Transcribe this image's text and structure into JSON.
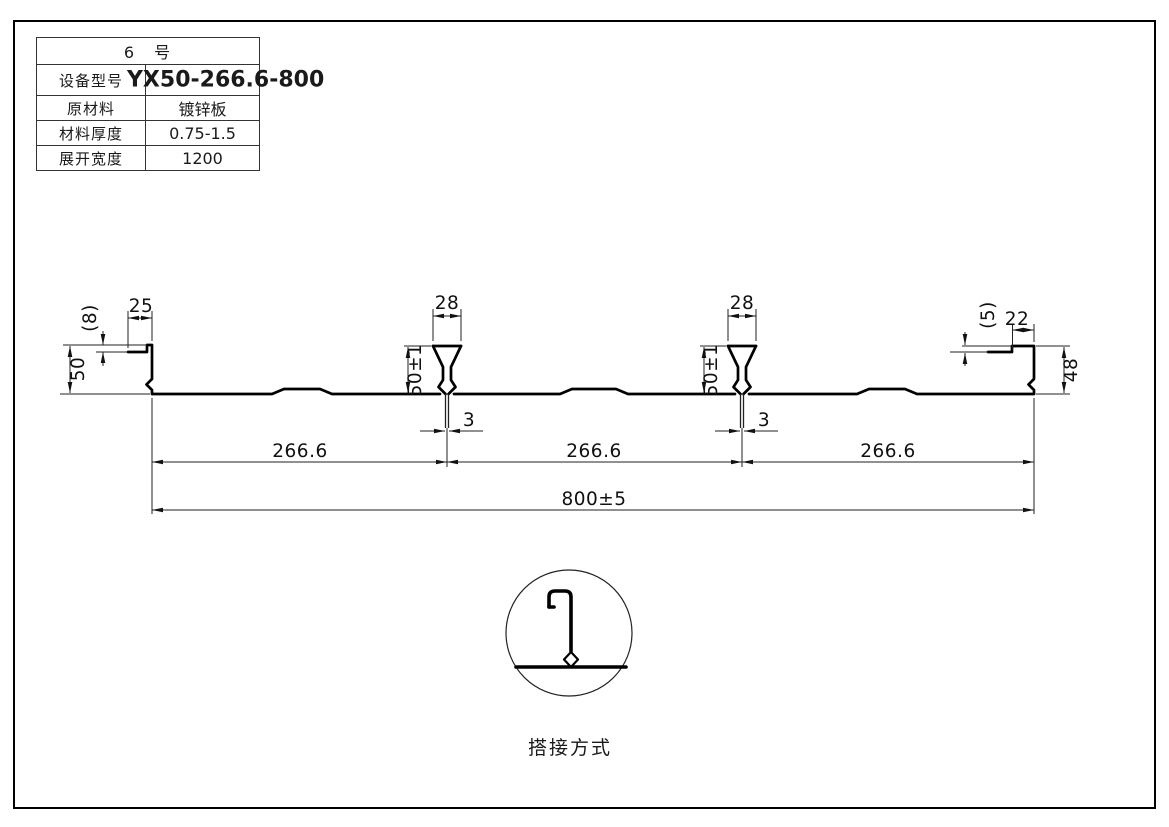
{
  "table": {
    "title": "6　号",
    "rows": [
      {
        "label": "设备型号",
        "value": "YX50-266.6-800"
      },
      {
        "label": "原材料",
        "value": "镀锌板"
      },
      {
        "label": "材料厚度",
        "value": "0.75-1.5"
      },
      {
        "label": "展开宽度",
        "value": "1200"
      }
    ]
  },
  "dimensions": {
    "left_step": "(8)",
    "left_lip_width": "25",
    "left_height": "50",
    "rib_top_width": "28",
    "rib_height": "50±1",
    "rib_slot_width": "3",
    "right_step": "(5)",
    "right_lip_width": "22",
    "right_height": "48",
    "pitch": "266.6",
    "overall_width": "800±5"
  },
  "detail": {
    "caption": "搭接方式"
  },
  "colors": {
    "line": "#111111",
    "background": "#ffffff"
  }
}
